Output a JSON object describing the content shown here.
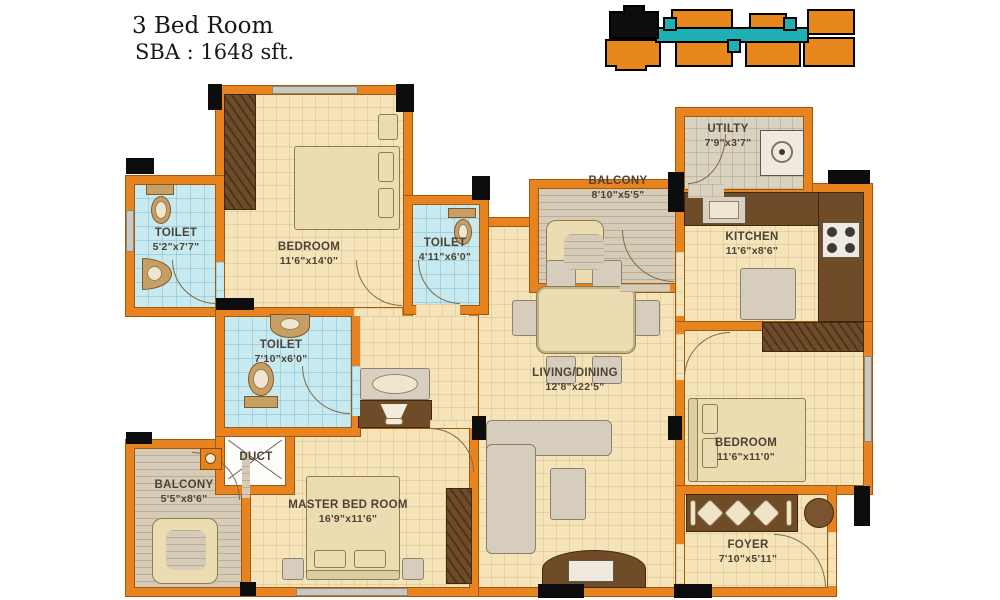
{
  "title": {
    "line1": "3 Bed Room",
    "line2": "SBA : 1648 sft."
  },
  "colors": {
    "wall_orange": "#e8841f",
    "wall_edge": "#a3590b",
    "beige_floor": "#f5e3ba",
    "toilet_floor": "#c7e9f0",
    "balcony_floor": "#d6cbb6",
    "utility_floor": "#dad2c0",
    "counter_brown": "#6f4b28",
    "keyplan_orange": "#e8881c",
    "keyplan_teal": "#1fb0b5",
    "keyplan_highlight": "#0d0d0d"
  },
  "rooms": {
    "toilet1": {
      "name": "TOILET",
      "dims": "5'2\"x7'7\""
    },
    "bedroom1": {
      "name": "BEDROOM",
      "dims": "11'6\"x14'0\""
    },
    "toilet2": {
      "name": "TOILET",
      "dims": "4'11\"x6'0\""
    },
    "balcony_top": {
      "name": "BALCONY",
      "dims": "8'10\"x5'5\""
    },
    "utility": {
      "name": "UTILTY",
      "dims": "7'9\"x3'7\""
    },
    "kitchen": {
      "name": "KITCHEN",
      "dims": "11'6\"x8'6\""
    },
    "toilet3": {
      "name": "TOILET",
      "dims": "7'10\"x6'0\""
    },
    "duct": {
      "name": "DUCT"
    },
    "living_dining": {
      "name": "LIVING/DINING",
      "dims": "12'8\"x22'5\""
    },
    "bedroom2": {
      "name": "BEDROOM",
      "dims": "11'6\"x11'0\""
    },
    "balcony_bottom": {
      "name": "BALCONY",
      "dims": "5'5\"x8'6\""
    },
    "master_bedroom": {
      "name": "MASTER BED ROOM",
      "dims": "16'9\"x11'6\""
    },
    "foyer": {
      "name": "FOYER",
      "dims": "7'10\"x5'11\""
    }
  }
}
